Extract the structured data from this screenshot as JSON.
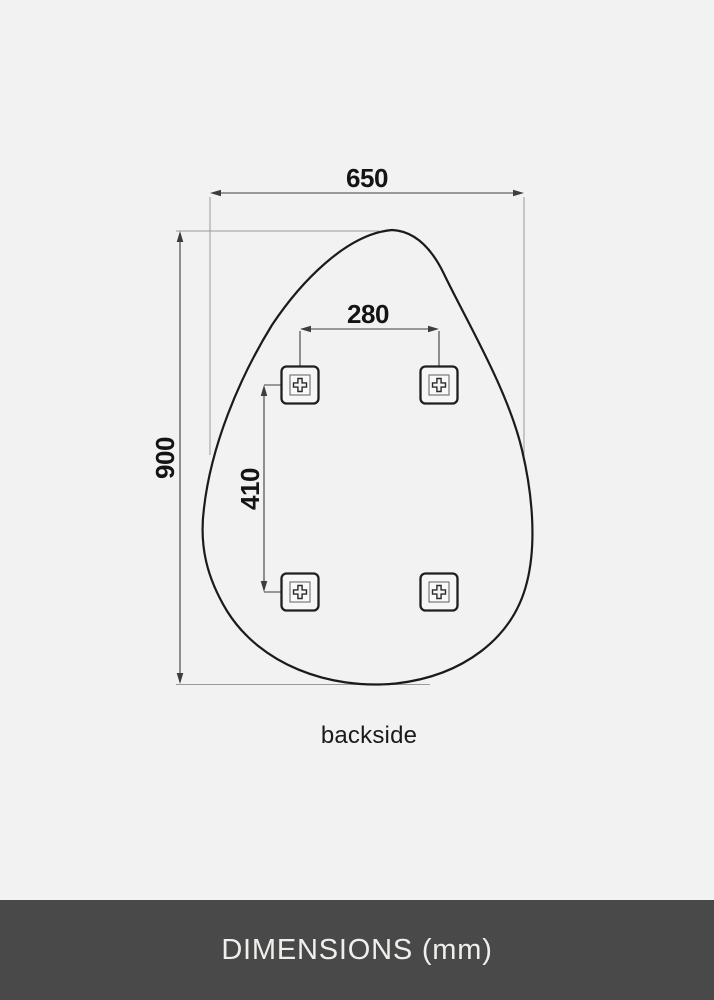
{
  "diagram": {
    "width_mm": "650",
    "height_mm": "900",
    "bracket_span_x_mm": "280",
    "bracket_span_y_mm": "410",
    "caption": "backside",
    "bracket_count": 4
  },
  "footer": {
    "label": "DIMENSIONS (mm)"
  },
  "colors": {
    "bg": "#f2f2f2",
    "footer-bg": "#494949",
    "footer-text": "#f1efec",
    "line-strong": "#1b1b1b",
    "line-dim": "#3d3d3d",
    "line-witness": "#9a9a9a",
    "label-color": "#141414"
  }
}
